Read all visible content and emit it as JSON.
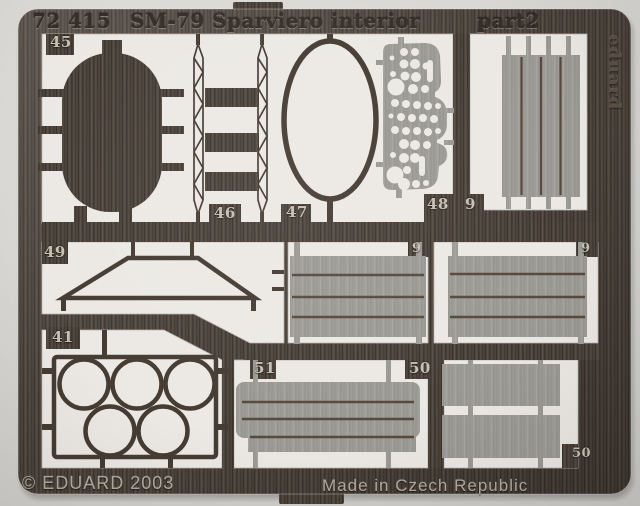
{
  "product": {
    "catalog_number": "72 415",
    "title": "SM-79 Sparviero interior",
    "part_suffix": "part2",
    "brand": "eduard",
    "copyright": "© EDUARD 2003",
    "made_in": "Made in Czech Republic"
  },
  "part_labels": {
    "oval_bulkhead": "45",
    "ladder_frame": "46",
    "oval_ring": "47",
    "instrument_panel": "48",
    "plank_panel_top_right": "9",
    "plank_panel_mid_left": "9",
    "plank_panel_mid_right": "9",
    "windshield_frame": "49",
    "circle_frame": "41",
    "stepped_floor_panel": "51",
    "rect_panels_label": "50",
    "rect_panels_corner_label": "50"
  },
  "colors": {
    "photo_background": "#d8d6d2",
    "fret_metal_dark": "#4b433c",
    "etched_opening": "#ece9e4",
    "half_etched_gray": "#9d9c97",
    "engraved_text_light": "#c7c0b4",
    "embossed_text_dark": "#362f29"
  }
}
